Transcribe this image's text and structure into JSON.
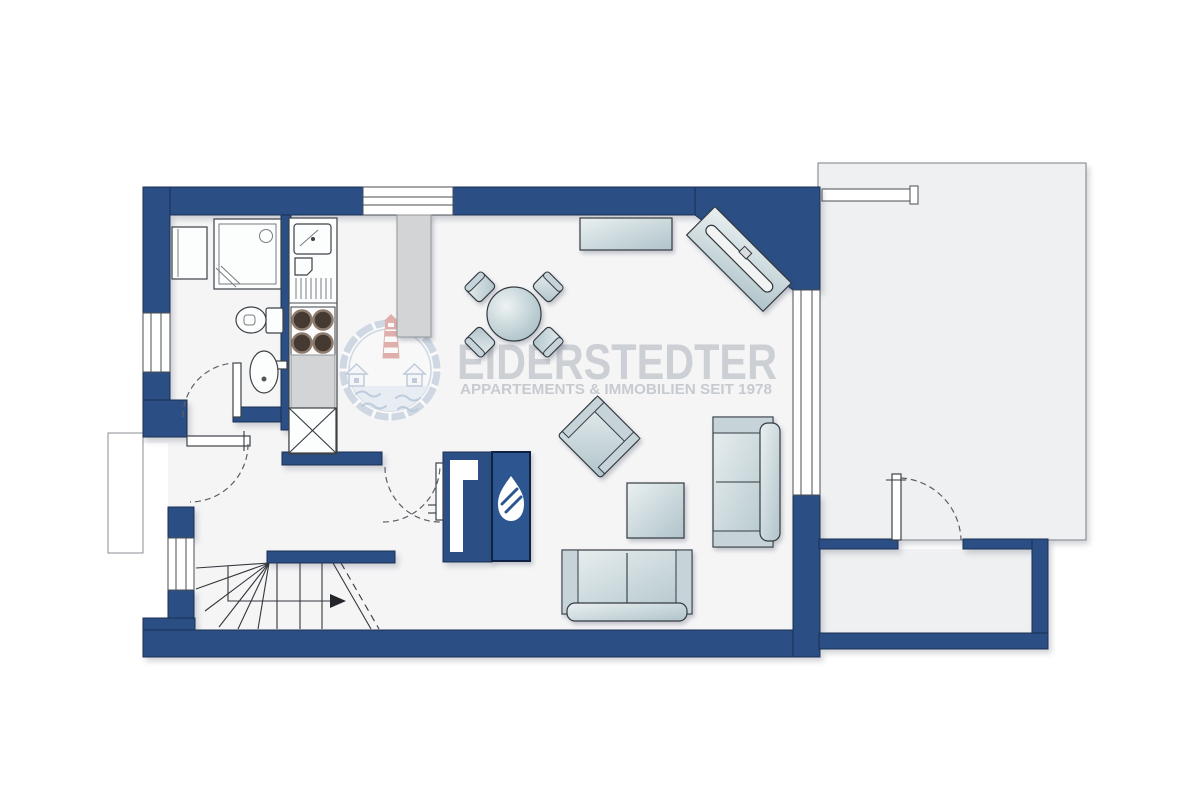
{
  "image": {
    "type": "apartment-floor-plan",
    "width": 1200,
    "height": 800
  },
  "watermark": {
    "title": "EIDERSTEDTER",
    "subtitle": "APPARTEMENTS & IMMOBILIEN SEIT 1978",
    "logo_icon": "lighthouse-lifebuoy-icon"
  },
  "colors": {
    "wall": "#2b4e84",
    "wall-stroke": "#1a3054",
    "fireplace": "#2d5590",
    "fireplace-stroke": "#0f2244",
    "floor": "#f5f5f6",
    "terrace": "#eef0f1",
    "gray-item": "#d3d4d5",
    "watermark-text": "#c9cdd3",
    "watermark-sub": "#c4c9cf",
    "logo-ring": "#a9bad0",
    "logo-red": "#cc6a63",
    "logo-wave": "#86a3c4"
  },
  "legend": {
    "rooms": [
      "bathroom",
      "hallway",
      "kitchen",
      "living-dining-room",
      "staircase",
      "terrace",
      "walled-patio",
      "entrance-porch"
    ],
    "fixtures": [
      "washing-machine",
      "shower",
      "toilet",
      "washbasin",
      "kitchen-sink-unit",
      "stove-4-burners",
      "tall-cabinet",
      "kitchen-counter-island",
      "fireplace"
    ],
    "furniture": [
      "round-dining-table",
      "dining-chair",
      "sideboard",
      "tv-lowboard",
      "armchair",
      "coffee-table",
      "three-seat-sofa",
      "two-seat-sofa"
    ],
    "openings": [
      "entrance-door",
      "bathroom-door",
      "living-room-door",
      "terrace-gate",
      "window"
    ]
  }
}
